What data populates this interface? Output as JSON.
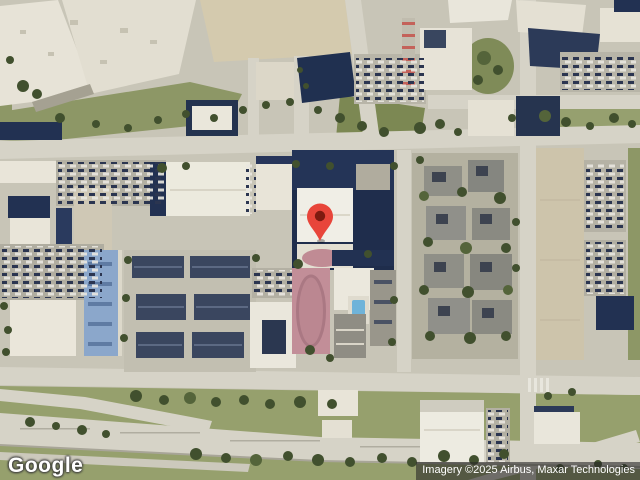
{
  "map": {
    "view_type": "satellite",
    "logo_text": "Google",
    "attribution": "Imagery ©2025 Airbus, Maxar Technologies",
    "marker": {
      "icon": "map-pin-icon",
      "color": "#E8453A",
      "outline_color": "#B33127",
      "inner_color": "#7E1A10"
    }
  }
}
